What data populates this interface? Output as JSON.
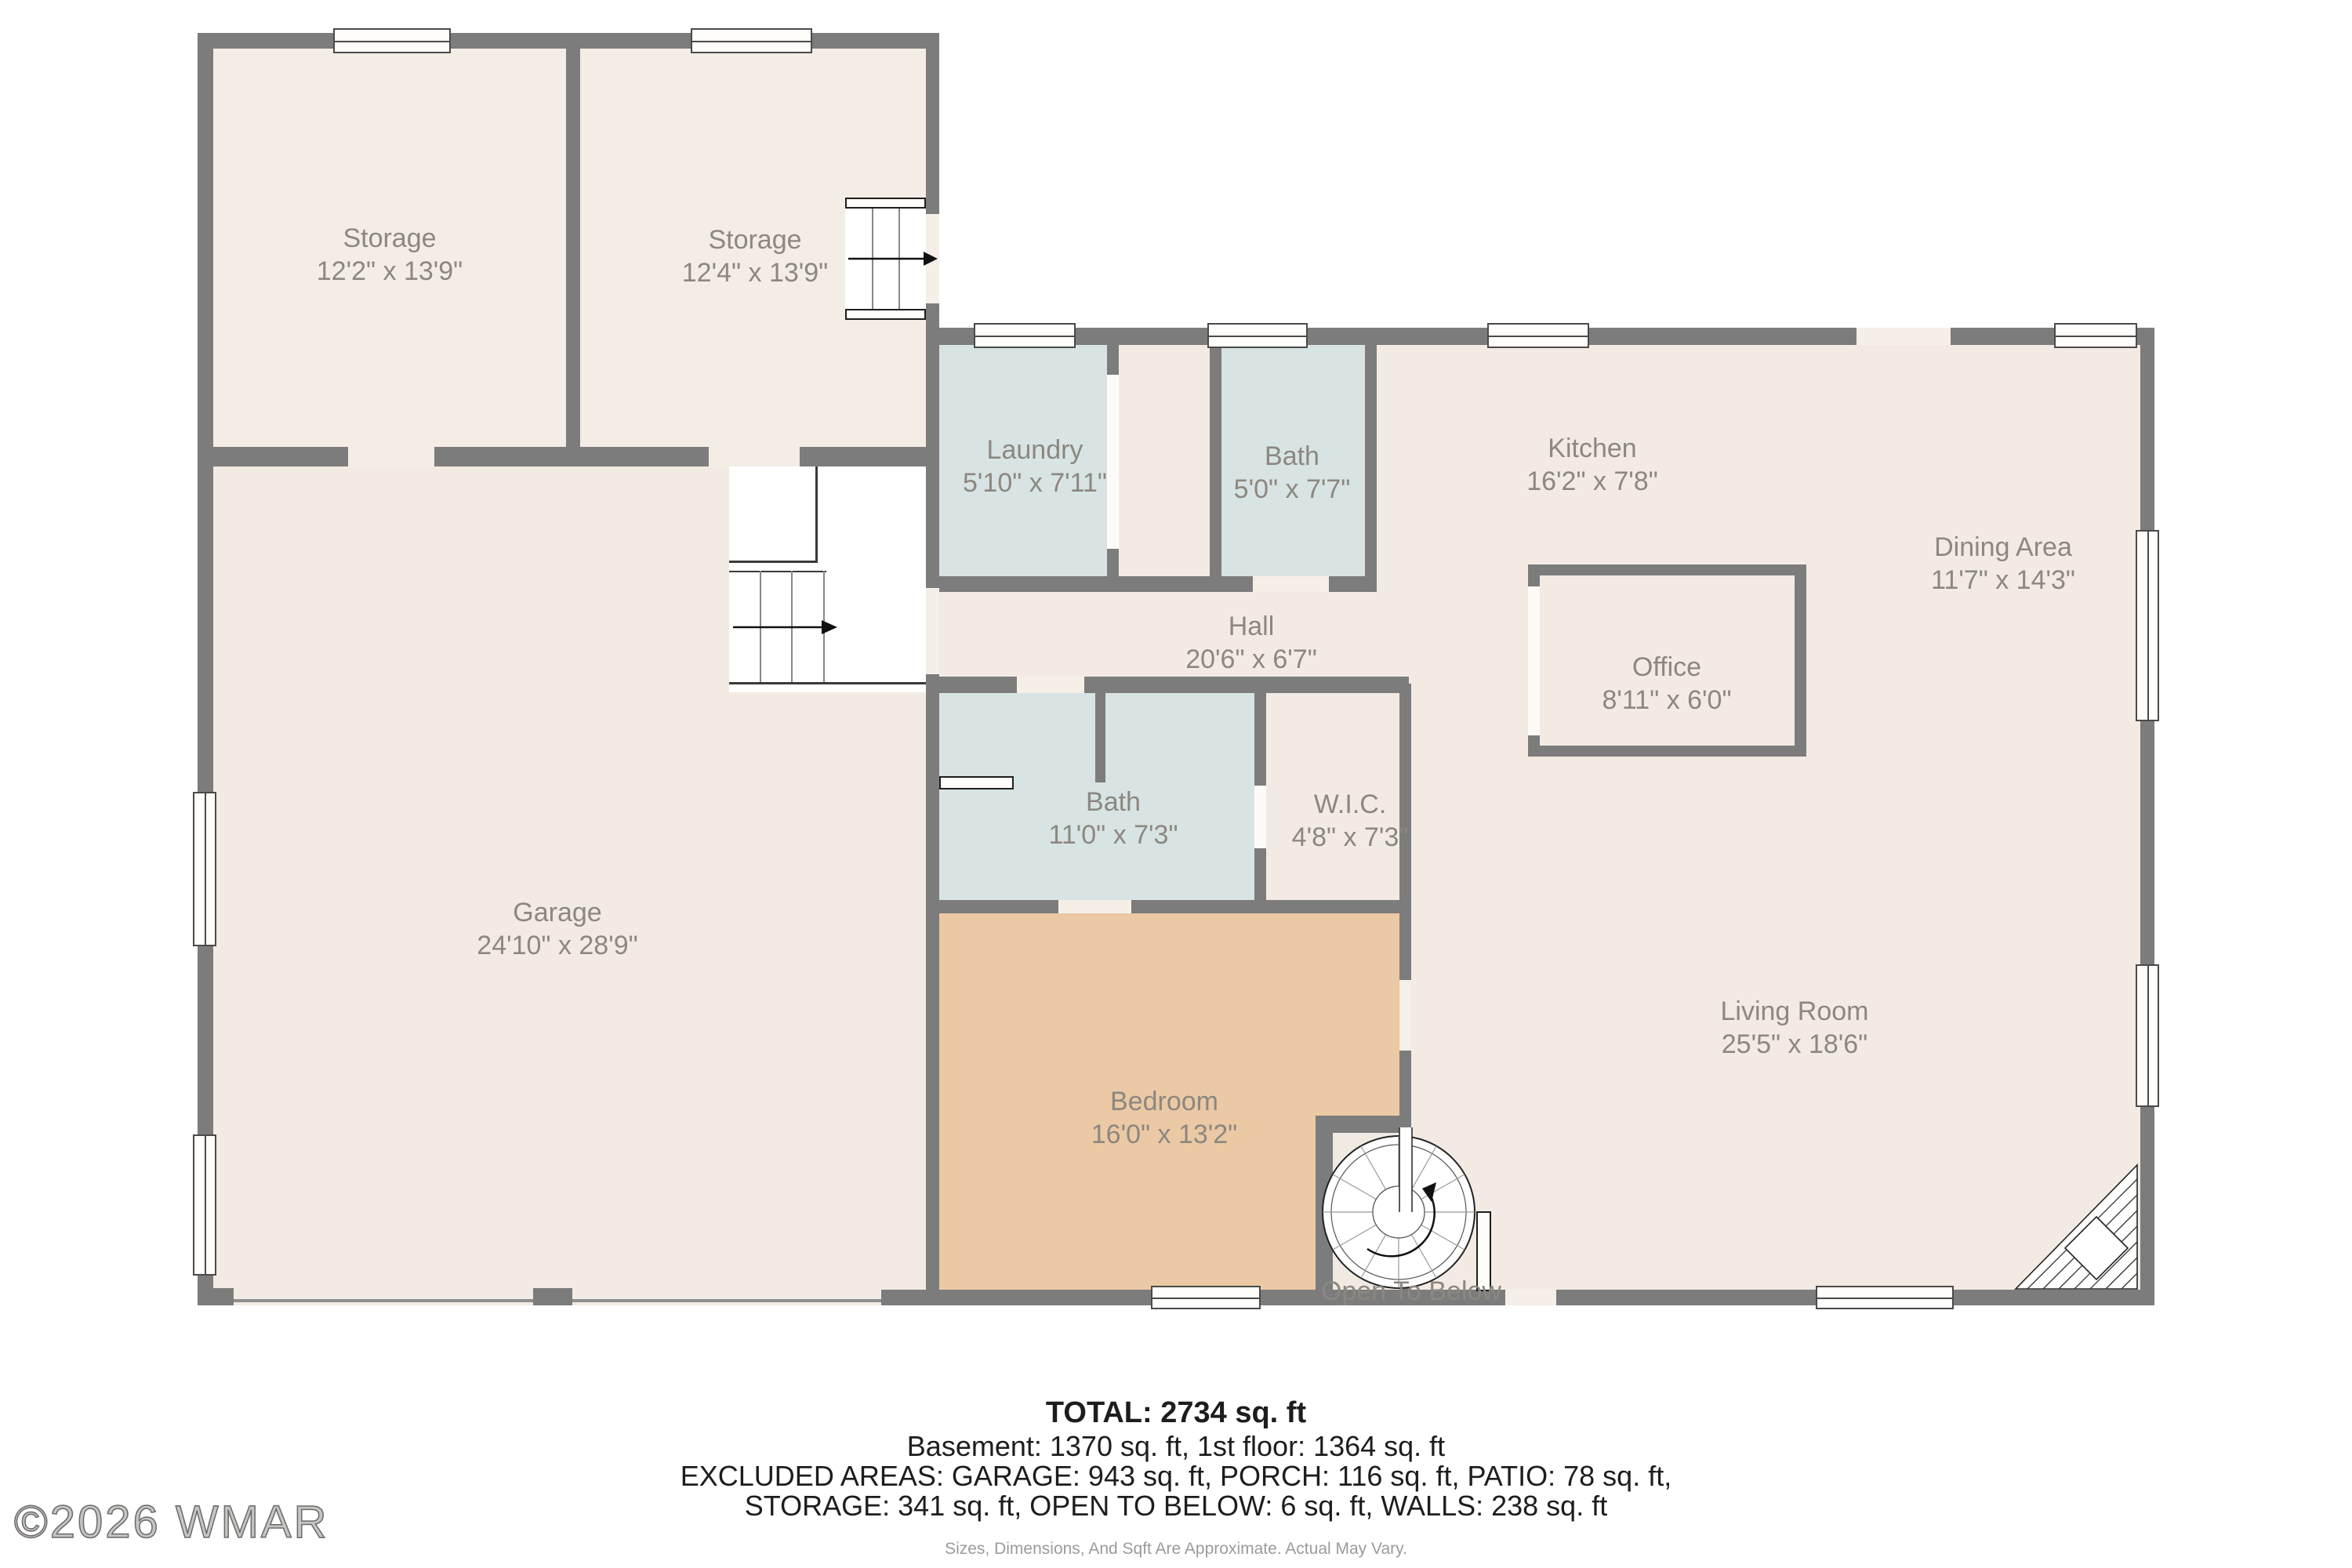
{
  "watermark": "©2026 WMAR",
  "rooms": {
    "storage1": {
      "name": "Storage",
      "dims": "12'2\" x 13'9\""
    },
    "storage2": {
      "name": "Storage",
      "dims": "12'4\" x 13'9\""
    },
    "laundry": {
      "name": "Laundry",
      "dims": "5'10\" x 7'11\""
    },
    "bath_upper": {
      "name": "Bath",
      "dims": "5'0\" x 7'7\""
    },
    "kitchen": {
      "name": "Kitchen",
      "dims": "16'2\" x 7'8\""
    },
    "dining": {
      "name": "Dining Area",
      "dims": "11'7\" x 14'3\""
    },
    "hall": {
      "name": "Hall",
      "dims": "20'6\" x 6'7\""
    },
    "office": {
      "name": "Office",
      "dims": "8'11\" x 6'0\""
    },
    "bath_lower": {
      "name": "Bath",
      "dims": "11'0\" x 7'3\""
    },
    "wic": {
      "name": "W.I.C.",
      "dims": "4'8\" x 7'3\""
    },
    "garage": {
      "name": "Garage",
      "dims": "24'10\" x 28'9\""
    },
    "bedroom": {
      "name": "Bedroom",
      "dims": "16'0\" x 13'2\""
    },
    "living": {
      "name": "Living Room",
      "dims": "25'5\" x 18'6\""
    },
    "open_below": {
      "name": "Open To Below"
    }
  },
  "summary": {
    "total": "TOTAL: 2734 sq. ft",
    "line1": "Basement: 1370 sq. ft, 1st floor: 1364 sq. ft",
    "line2": "EXCLUDED AREAS: GARAGE: 943 sq. ft, PORCH: 116 sq. ft, PATIO: 78 sq. ft,",
    "line3": "STORAGE: 341 sq. ft, OPEN TO BELOW: 6 sq. ft, WALLS: 238 sq. ft",
    "disclaimer": "Sizes, Dimensions, And Sqft Are Approximate. Actual May Vary."
  },
  "colors": {
    "wall": "#7c7c7c",
    "floor_cream": "#f3ebe3",
    "floor_storage": "#f4ede6",
    "bath_blue": "#d8e4e3",
    "bedroom_tan": "#ebc9a4",
    "label_gray": "#8c8781"
  }
}
